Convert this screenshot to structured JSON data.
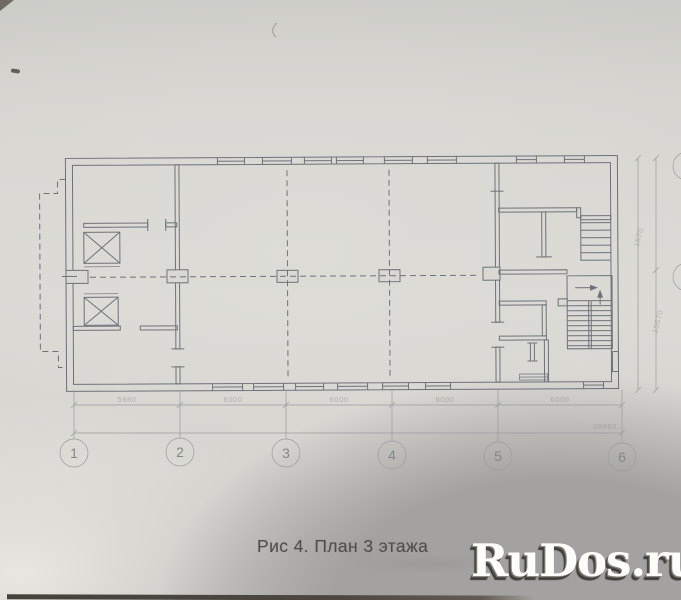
{
  "figure": {
    "caption": "Рис 4. План 3 этажа"
  },
  "watermark": {
    "text": "RuDos.ru"
  },
  "grid": {
    "columns": [
      "1",
      "2",
      "3",
      "4",
      "5",
      "6"
    ]
  },
  "dimensions": {
    "bays": [
      "5980",
      "6000",
      "6000",
      "6000",
      "6000"
    ],
    "total": "29980",
    "side_upper": "1570",
    "side_lower": "15570"
  },
  "colors": {
    "paper": "#d9d8d3",
    "ink": "#6d727a",
    "axis": "#989d9e",
    "photo_shadow": "#a3a2a0",
    "watermark_text": "#fdfdfa",
    "caption_text": "#514e4a"
  }
}
